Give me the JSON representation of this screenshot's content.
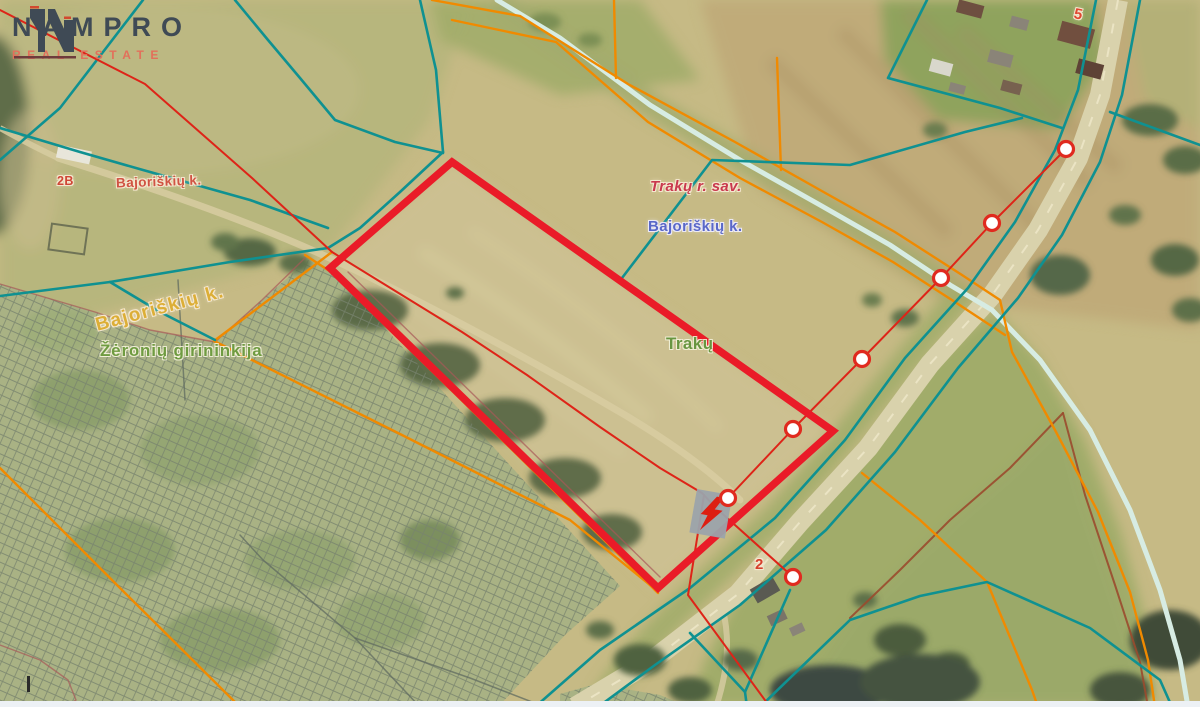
{
  "logo": {
    "brand": "NAMPRO",
    "tagline": "REAL ESTATE"
  },
  "map": {
    "labels": {
      "municipality": "Trakų r. sav.",
      "village_blue": "Bajoriškių k.",
      "village_red": "Bajoriškių k.",
      "village_yellow": "Bajoriškių k.",
      "forestry": "Žėronių girininkija",
      "city": "Trakų",
      "plot5": "5",
      "plot2": "2",
      "plot2b": "2B"
    },
    "plot_outline": {
      "color": "#ea1b28",
      "width": 7.5,
      "points": [
        [
          452,
          162
        ],
        [
          833,
          431
        ],
        [
          658,
          588
        ],
        [
          330,
          268
        ]
      ]
    },
    "markers": {
      "fill": "#ffffff",
      "stroke": "#e02a1f",
      "stroke_width": 3.2,
      "radius": 7.5,
      "points": [
        [
          1066,
          149
        ],
        [
          992,
          223
        ],
        [
          941,
          278
        ],
        [
          862,
          359
        ],
        [
          793,
          429
        ],
        [
          728,
          498
        ],
        [
          793,
          577
        ]
      ]
    },
    "hydro": {
      "color": "#d7ece3",
      "width": 5,
      "paths": [
        [
          [
            497,
            0
          ],
          [
            560,
            38
          ],
          [
            650,
            105
          ],
          [
            740,
            160
          ],
          [
            820,
            205
          ],
          [
            890,
            245
          ],
          [
            950,
            285
          ],
          [
            992,
            310
          ],
          [
            1040,
            360
          ],
          [
            1090,
            430
          ],
          [
            1130,
            510
          ],
          [
            1160,
            590
          ],
          [
            1180,
            660
          ],
          [
            1188,
            707
          ]
        ]
      ]
    },
    "line_groups": {
      "gray": {
        "color": "#606b60",
        "width": 1.5,
        "opacity": 0.75,
        "paths": [
          [
            [
              240,
              535
            ],
            [
              263,
              560
            ],
            [
              355,
              638
            ],
            [
              420,
              707
            ]
          ],
          [
            [
              355,
              638
            ],
            [
              470,
              678
            ],
            [
              545,
              707
            ]
          ],
          [
            [
              178,
              280
            ],
            [
              185,
              400
            ]
          ]
        ]
      },
      "maroon": {
        "color": "#a85858",
        "width": 1.4,
        "opacity": 0.7,
        "paths": [
          [
            [
              0,
              284
            ],
            [
              95,
              312
            ],
            [
              150,
              330
            ],
            [
              215,
              342
            ],
            [
              262,
              300
            ],
            [
              305,
              258
            ]
          ],
          [
            [
              0,
              645
            ],
            [
              40,
              660
            ],
            [
              68,
              680
            ],
            [
              76,
              700
            ],
            [
              66,
              707
            ]
          ],
          [
            [
              348,
              272
            ],
            [
              660,
              577
            ]
          ]
        ]
      },
      "brown": {
        "color": "#9a4a2e",
        "width": 2,
        "opacity": 0.9,
        "paths": [
          [
            [
              1063,
              413
            ],
            [
              1010,
              468
            ],
            [
              950,
              520
            ],
            [
              900,
              570
            ],
            [
              850,
              618
            ]
          ],
          [
            [
              1063,
              413
            ],
            [
              1085,
              495
            ],
            [
              1115,
              585
            ],
            [
              1140,
              662
            ],
            [
              1148,
              707
            ]
          ]
        ]
      },
      "orange": {
        "color": "#f08a00",
        "width": 2.4,
        "opacity": 1,
        "paths": [
          [
            [
              432,
              0
            ],
            [
              520,
              16
            ],
            [
              628,
              84
            ],
            [
              735,
              142
            ],
            [
              820,
              190
            ],
            [
              895,
              232
            ],
            [
              962,
              275
            ],
            [
              1000,
              300
            ],
            [
              1012,
              352
            ],
            [
              1055,
              430
            ],
            [
              1098,
              512
            ],
            [
              1130,
              592
            ],
            [
              1148,
              660
            ],
            [
              1155,
              707
            ]
          ],
          [
            [
              452,
              20
            ],
            [
              556,
              42
            ],
            [
              648,
              122
            ],
            [
              740,
              178
            ],
            [
              822,
              222
            ],
            [
              893,
              262
            ],
            [
              955,
              302
            ],
            [
              1005,
              335
            ]
          ],
          [
            [
              614,
              0
            ],
            [
              616,
              78
            ]
          ],
          [
            [
              777,
              58
            ],
            [
              781,
              170
            ]
          ],
          [
            [
              305,
              255
            ],
            [
              331,
              272
            ],
            [
              658,
              593
            ]
          ],
          [
            [
              0,
              468
            ],
            [
              120,
              588
            ],
            [
              240,
              707
            ]
          ],
          [
            [
              332,
              252
            ],
            [
              214,
              341
            ]
          ],
          [
            [
              214,
              341
            ],
            [
              400,
              434
            ],
            [
              570,
              520
            ],
            [
              650,
              585
            ]
          ],
          [
            [
              862,
              473
            ],
            [
              920,
              520
            ],
            [
              987,
              582
            ],
            [
              1032,
              690
            ],
            [
              1038,
              707
            ]
          ]
        ]
      },
      "teal": {
        "color": "#0f9191",
        "width": 2.6,
        "opacity": 1,
        "paths": [
          [
            [
              1096,
              0
            ],
            [
              1078,
              90
            ],
            [
              1055,
              150
            ],
            [
              1015,
              222
            ],
            [
              968,
              288
            ],
            [
              905,
              358
            ],
            [
              845,
              440
            ],
            [
              775,
              518
            ],
            [
              690,
              588
            ],
            [
              600,
              650
            ],
            [
              535,
              707
            ]
          ],
          [
            [
              1140,
              0
            ],
            [
              1122,
              95
            ],
            [
              1100,
              162
            ],
            [
              1062,
              235
            ],
            [
              1018,
              298
            ],
            [
              958,
              368
            ],
            [
              895,
              452
            ],
            [
              826,
              530
            ],
            [
              740,
              605
            ],
            [
              655,
              665
            ],
            [
              598,
              707
            ]
          ],
          [
            [
              1110,
              112
            ],
            [
              1200,
              145
            ]
          ],
          [
            [
              143,
              0
            ],
            [
              60,
              108
            ],
            [
              0,
              160
            ]
          ],
          [
            [
              235,
              0
            ],
            [
              268,
              40
            ],
            [
              300,
              78
            ],
            [
              335,
              120
            ],
            [
              395,
              142
            ],
            [
              443,
              153
            ]
          ],
          [
            [
              420,
              0
            ],
            [
              436,
              70
            ],
            [
              443,
              152
            ]
          ],
          [
            [
              443,
              152
            ],
            [
              400,
              192
            ],
            [
              360,
              228
            ],
            [
              328,
              248
            ]
          ],
          [
            [
              0,
              128
            ],
            [
              80,
              152
            ],
            [
              143,
              170
            ],
            [
              250,
              200
            ],
            [
              328,
              228
            ]
          ],
          [
            [
              328,
              248
            ],
            [
              230,
              262
            ],
            [
              110,
              282
            ],
            [
              0,
              296
            ]
          ],
          [
            [
              110,
              282
            ],
            [
              160,
              312
            ],
            [
              215,
              340
            ]
          ],
          [
            [
              1022,
              118
            ],
            [
              965,
              132
            ],
            [
              850,
              165
            ],
            [
              712,
              160
            ],
            [
              622,
              278
            ]
          ],
          [
            [
              927,
              0
            ],
            [
              888,
              78
            ],
            [
              1000,
              108
            ],
            [
              1062,
              128
            ]
          ],
          [
            [
              790,
              590
            ],
            [
              745,
              692
            ],
            [
              747,
              707
            ]
          ],
          [
            [
              690,
              633
            ],
            [
              745,
              692
            ]
          ],
          [
            [
              760,
              707
            ],
            [
              850,
              620
            ],
            [
              920,
              596
            ],
            [
              987,
              582
            ],
            [
              1090,
              628
            ],
            [
              1160,
              680
            ],
            [
              1172,
              707
            ]
          ]
        ]
      },
      "power_red": {
        "color": "#de2418",
        "width": 2,
        "opacity": 1,
        "paths": [
          [
            [
              0,
              10
            ],
            [
              145,
              84
            ],
            [
              252,
              178
            ],
            [
              332,
              252
            ],
            [
              462,
              332
            ],
            [
              527,
              375
            ],
            [
              600,
              427
            ],
            [
              660,
              468
            ],
            [
              702,
              493
            ],
            [
              716,
              508
            ]
          ],
          [
            [
              716,
              508
            ],
            [
              728,
              498
            ],
            [
              793,
              429
            ],
            [
              862,
              359
            ],
            [
              941,
              278
            ],
            [
              992,
              223
            ],
            [
              1066,
              149
            ]
          ],
          [
            [
              716,
              508
            ],
            [
              793,
              577
            ]
          ],
          [
            [
              704,
              495
            ],
            [
              688,
              595
            ],
            [
              770,
              707
            ]
          ]
        ]
      }
    }
  }
}
